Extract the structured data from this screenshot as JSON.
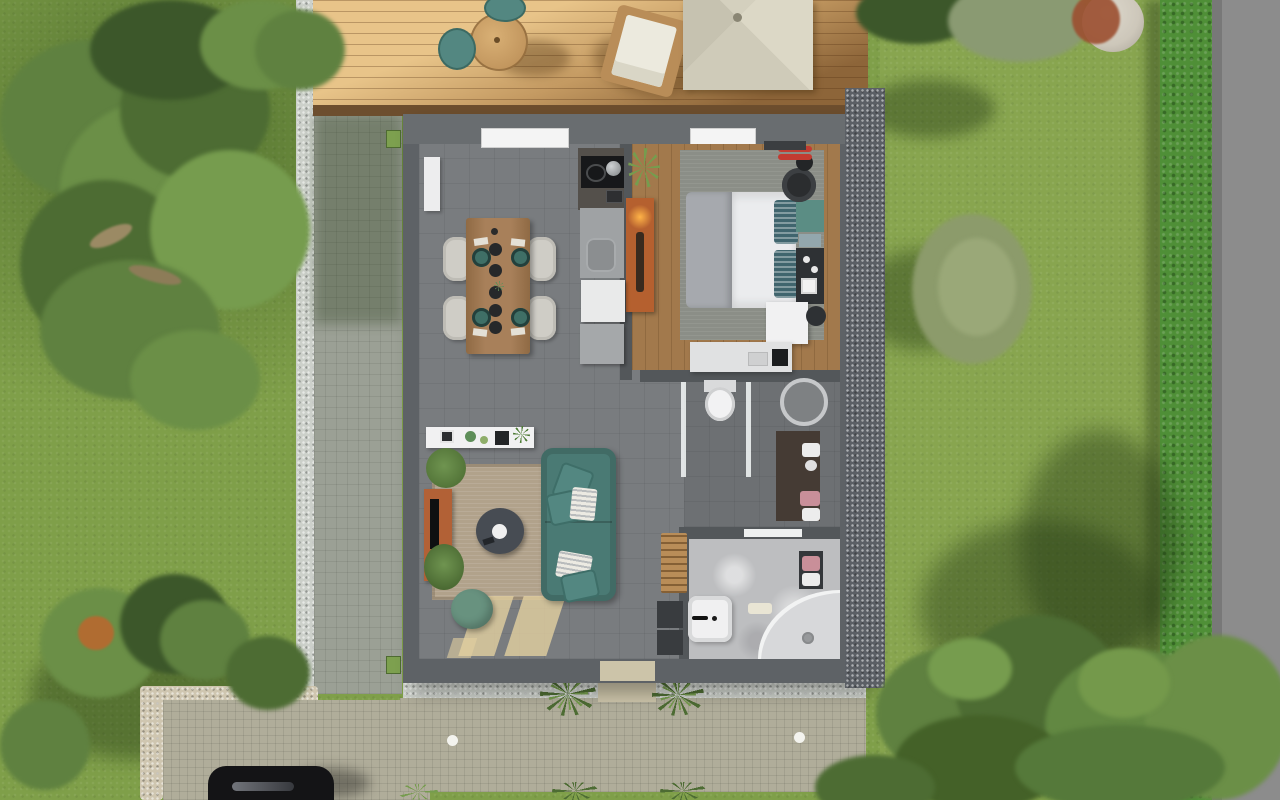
{
  "scene": {
    "description": "aerial top-down 3D architectural rendering of a small single-storey house with garden, wooden deck, paved paths, driveway with parked car",
    "canvas": {
      "width": 1280,
      "height": 800
    },
    "rooms": [
      "living-dining-kitchen",
      "bedroom",
      "wc",
      "bathroom"
    ],
    "garden_objects": [
      "large-tree",
      "bushes",
      "hedge",
      "rock",
      "road",
      "paved-path",
      "stone-border",
      "driveway",
      "black-car",
      "terrace",
      "ground-lights",
      "grass-plants"
    ],
    "deck_objects": [
      "round-table",
      "two-teal-chairs",
      "sun-lounger",
      "pavilion-canopy"
    ],
    "interior_objects": [
      "dining-table-with-4-chairs",
      "kitchen-block-cooktop-sink",
      "sofa-teal",
      "coffee-table",
      "tv-sideboard",
      "pouf",
      "double-bed",
      "wardrobe-orange",
      "desk",
      "toilet",
      "round-basin",
      "vanity",
      "shower-corner",
      "bathroom-sink",
      "towel-ladder"
    ]
  },
  "colors": {
    "grass": "#7f9f49",
    "grassDark": "#4e6b31",
    "grassLight": "#93b258",
    "road": "#8c8c8c",
    "hedge": "#4f8f37",
    "path": "#9ba095",
    "gravelLight": "#ccd0ca",
    "gravelDark": "#5b5f65",
    "stone": "#cfc6b0",
    "terrace": "#b0ad9a",
    "doorPath": "#ccc4a9",
    "deckLight": "#e8c489",
    "deckMid": "#c49a62",
    "deckDark": "#8d6539",
    "deckEdge": "#6d4e2e",
    "pavilion": "#d8d4c2",
    "wall": "#5e6266",
    "wallTop": "#696d70",
    "partition": "#53575a",
    "floorTile": "#797c7f",
    "floorWC": "#6d7073",
    "floorBath": "#bdbec0",
    "wood": "#a2794c",
    "rugBeige": "#b1a28b",
    "rugGray": "#8b8e87",
    "sofa": "#4a7a74",
    "teal": "#538781",
    "pouf": "#68927f",
    "tableWood": "#a8805a",
    "chairWhite": "#cfcdc6",
    "plate": "#3f6f66",
    "counter": "#9fa2a4",
    "cooktop": "#17181a",
    "appliance": "#e9eaea",
    "concrete": "#54504b",
    "wardrobe": "#b5602f",
    "glow": "#ffb347",
    "tv": "#b26136",
    "duvet": "#ebecee",
    "blanket": "#a6a9ae",
    "pillow": "#40656e",
    "headboard": "#5b8d84",
    "darkUnit": "#2e3134",
    "whiteFurn": "#f1f1f2",
    "desk": "#e0e1e2",
    "vanity": "#453b34",
    "towelPink": "#c98f99",
    "ladder": "#b98d58",
    "shower": "#d7d8da",
    "treeGreen1": "#5f8140",
    "treeGreen2": "#6b8f47",
    "treeGreen3": "#4d6c33",
    "treeGreen4": "#769c4e",
    "treeDark": "#3c572a",
    "olive": "#8c9b6b",
    "bushGray": "#8a9a72",
    "rock": "#cdc7ba",
    "redBush": "#9c4f30",
    "car": "#141416",
    "groundLight": "#f3f3ee",
    "greenBox": "#7da04f"
  }
}
